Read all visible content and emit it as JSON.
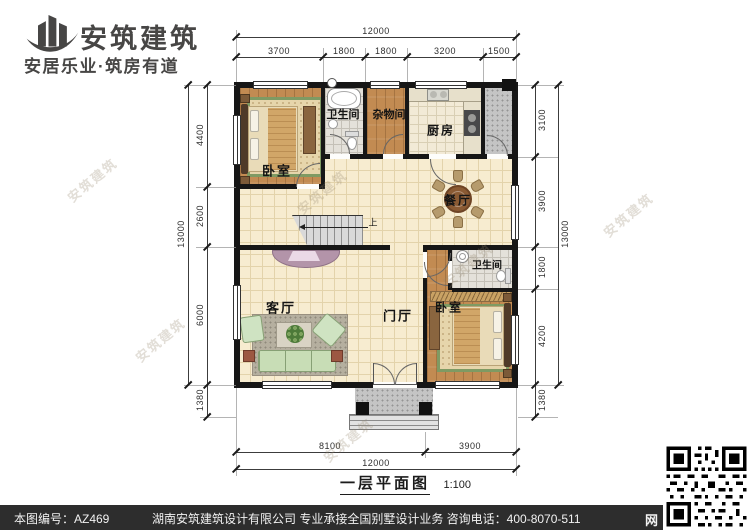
{
  "brand": {
    "name": "安筑建筑",
    "slogan": "安居乐业·筑房有道",
    "logo_icon": "building-swoosh-icon",
    "color": "#474645"
  },
  "plan": {
    "title": "一层平面图",
    "scale_label": "1:100",
    "rooms": {
      "bedroom_top": {
        "label": "卧室"
      },
      "bathroom_top": {
        "label": "卫生间"
      },
      "storage": {
        "label": "杂物间"
      },
      "kitchen": {
        "label": "厨房"
      },
      "dining": {
        "label": "餐厅"
      },
      "living": {
        "label": "客厅"
      },
      "foyer": {
        "label": "门厅"
      },
      "bathroom_right": {
        "label": "卫生间"
      },
      "bedroom_bottom": {
        "label": "卧室"
      },
      "stairs": {
        "label": "上"
      }
    },
    "dimensions": {
      "top_total": "12000",
      "top_segments": [
        "3700",
        "1800",
        "1800",
        "3200",
        "1500"
      ],
      "bottom_segments": [
        "8100",
        "3900"
      ],
      "bottom_total": "12000",
      "left_segments": [
        "4400",
        "2600",
        "6000",
        "1380"
      ],
      "left_total": "13000",
      "right_segments": [
        "3100",
        "3900",
        "1800",
        "4200",
        "1380"
      ],
      "right_total": "13000"
    }
  },
  "watermark": {
    "text": "安筑建筑"
  },
  "footer": {
    "sheet_number": "本图编号：AZ469",
    "company_line": "湖南安筑建筑设计有限公司  专业承接全国别墅设计业务  咨询电话：400-8070-511",
    "net_char": "网",
    "bar_color": "#2d2d2d",
    "qr_icon": "qr-code"
  }
}
